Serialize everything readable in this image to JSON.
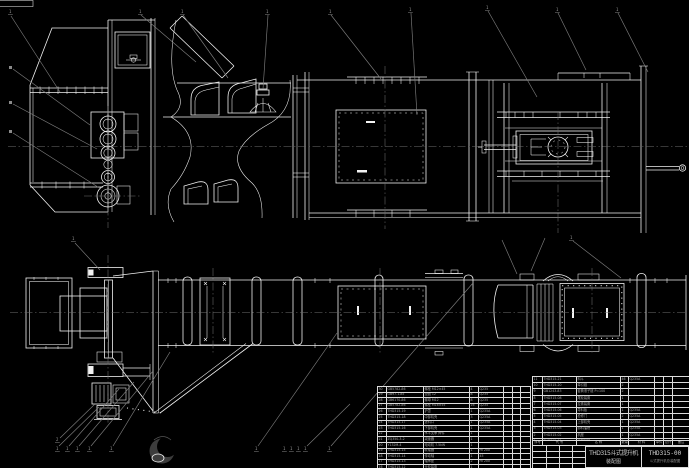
{
  "drawing": {
    "background": "#000000",
    "line_color": "#f2f2f2",
    "leader_color": "#7d7d7d",
    "table_border_color": "#dcdcdc",
    "table_text_color": "#a8a8a8"
  },
  "title_block": {
    "product": "THD315斗式提升机",
    "doc_type": "装配图",
    "drawing_no": "THD315-00",
    "drawing_no_sub": "斗式提升机总装配图"
  },
  "bom": {
    "header_rows": [
      [
        "序号",
        "代  号",
        "名  称",
        "数量",
        "材 料",
        "单件",
        "总计",
        "备注"
      ]
    ],
    "left_rows": [
      [
        "30",
        "GB5782-86",
        "螺栓 M12×45",
        "4",
        "Q235",
        "",
        "",
        ""
      ],
      [
        "29",
        "GB97.1-85",
        "垫圈 12",
        "8",
        "Q235",
        "",
        "",
        ""
      ],
      [
        "28",
        "GB6170-86",
        "螺母 M12",
        "8",
        "Q235",
        "",
        "",
        ""
      ],
      [
        "27",
        "GB5782-86",
        "螺栓 M16×55",
        "16",
        "Q235",
        "",
        "",
        ""
      ],
      [
        "26",
        "THD315-19",
        "护罩",
        "1",
        "Q235A",
        "",
        "",
        ""
      ],
      [
        "25",
        "THD315-18",
        "中部机壳",
        "3",
        "Q235A",
        "",
        "",
        ""
      ],
      [
        "24",
        "THD315-17",
        "进料口",
        "1",
        "Q235A",
        "",
        "",
        ""
      ],
      [
        "23",
        "THD315-16",
        "下部机壳",
        "1",
        "Q235A",
        "",
        "",
        ""
      ],
      [
        "22",
        "",
        "水平支承 焊件",
        "1",
        "",
        "",
        "",
        ""
      ],
      [
        "21",
        "ZQ350-3-2",
        "减速器",
        "1",
        "",
        "",
        "",
        ""
      ],
      [
        "20",
        "Y132M-4",
        "电动机 7.5kW",
        "1",
        "",
        "",
        "",
        ""
      ],
      [
        "19",
        "THD315-15",
        "联轴器",
        "1",
        "HT200",
        "",
        "",
        ""
      ],
      [
        "18",
        "THD315-14",
        "传动轴",
        "1",
        "45",
        "",
        "",
        ""
      ],
      [
        "17",
        "THD315-13",
        "轴承座",
        "2",
        "HT200",
        "",
        "",
        ""
      ],
      [
        "16",
        "THD315-12",
        "头轮装置",
        "1",
        "",
        "",
        "",
        ""
      ],
      [
        "15",
        "THD315-11",
        "卸料口",
        "1",
        "Q235A",
        "",
        "",
        ""
      ]
    ],
    "right_rows": [
      [
        "11",
        "THD315-21",
        "料斗",
        "46",
        "Q235A",
        "",
        "",
        ""
      ],
      [
        "10",
        "THD315-20",
        "牵引链",
        "2",
        "",
        "",
        "",
        ""
      ],
      [
        "9",
        "GB1243-83",
        "套筒滚子链 P=100",
        "2",
        "",
        "",
        "",
        ""
      ],
      [
        "8",
        "THD315-08",
        "尾轮装置",
        "1",
        "",
        "",
        "",
        ""
      ],
      [
        "7",
        "THD315-07",
        "拉紧装置",
        "1",
        "",
        "",
        "",
        ""
      ],
      [
        "6",
        "THD315-06",
        "导料板",
        "1",
        "Q235A",
        "",
        "",
        ""
      ],
      [
        "5",
        "THD315-05",
        "检修门",
        "2",
        "Q235A",
        "",
        "",
        ""
      ],
      [
        "4",
        "THD315-04",
        "上部机壳",
        "1",
        "Q235A",
        "",
        "",
        ""
      ],
      [
        "3",
        "THD315-03",
        "卸料溜槽",
        "1",
        "Q235A",
        "",
        "",
        ""
      ],
      [
        "2",
        "THD315-02",
        "机座",
        "1",
        "Q235A",
        "",
        "",
        ""
      ],
      [
        "1",
        "THD315-01",
        "下部区段",
        "1",
        "",
        "",
        "",
        ""
      ]
    ],
    "sign_rows": [
      [
        "",
        "",
        "",
        ""
      ],
      [
        "",
        "",
        "",
        ""
      ],
      [
        "",
        "",
        "",
        ""
      ],
      [
        "",
        "",
        "",
        ""
      ]
    ]
  },
  "callouts": [
    {
      "x": 9,
      "y": 13,
      "label": "1"
    },
    {
      "x": 139,
      "y": 13,
      "label": "1"
    },
    {
      "x": 181,
      "y": 13,
      "label": "1"
    },
    {
      "x": 266,
      "y": 13,
      "label": "1"
    },
    {
      "x": 329,
      "y": 13,
      "label": "1"
    },
    {
      "x": 409,
      "y": 11,
      "label": "1"
    },
    {
      "x": 486,
      "y": 9,
      "label": "1"
    },
    {
      "x": 556,
      "y": 11,
      "label": "1"
    },
    {
      "x": 616,
      "y": 11,
      "label": "1"
    },
    {
      "x": 72,
      "y": 240,
      "label": "1"
    },
    {
      "x": 570,
      "y": 239,
      "label": "1"
    },
    {
      "x": 56,
      "y": 441,
      "label": "2"
    },
    {
      "x": 56,
      "y": 450,
      "label": "1"
    },
    {
      "x": 66,
      "y": 450,
      "label": "1"
    },
    {
      "x": 76,
      "y": 450,
      "label": "1"
    },
    {
      "x": 88,
      "y": 450,
      "label": "1"
    },
    {
      "x": 110,
      "y": 450,
      "label": "1"
    },
    {
      "x": 255,
      "y": 450,
      "label": "1"
    },
    {
      "x": 283,
      "y": 450,
      "label": "1"
    },
    {
      "x": 290,
      "y": 450,
      "label": "1"
    },
    {
      "x": 297,
      "y": 450,
      "label": "1"
    },
    {
      "x": 304,
      "y": 450,
      "label": "1"
    },
    {
      "x": 328,
      "y": 450,
      "label": "1"
    }
  ]
}
